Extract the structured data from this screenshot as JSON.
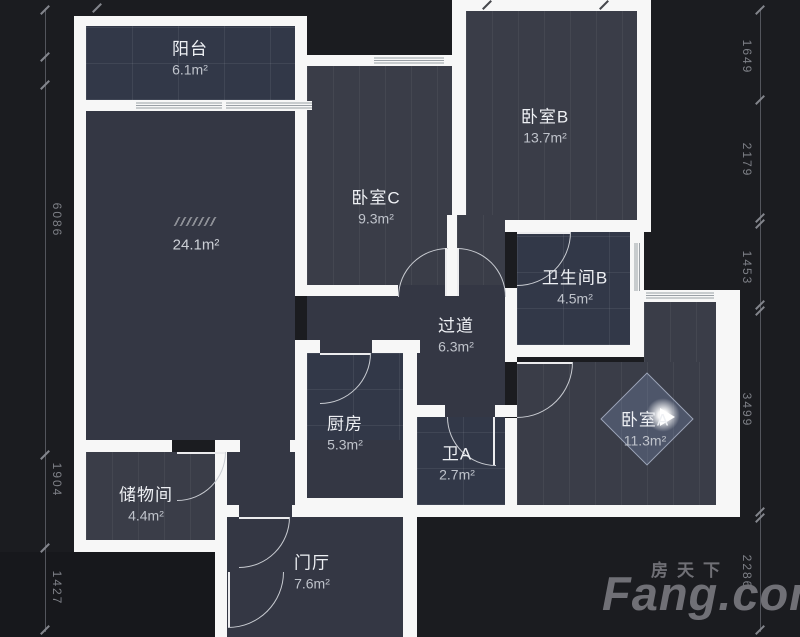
{
  "rooms": {
    "balcony": {
      "name": "阳台",
      "area": "6.1m²"
    },
    "living": {
      "name": "",
      "area": "24.1m²"
    },
    "bedroom_c": {
      "name": "卧室C",
      "area": "9.3m²"
    },
    "bedroom_b": {
      "name": "卧室B",
      "area": "13.7m²"
    },
    "bathroom_b": {
      "name": "卫生间B",
      "area": "4.5m²"
    },
    "corridor": {
      "name": "过道",
      "area": "6.3m²"
    },
    "kitchen": {
      "name": "厨房",
      "area": "5.3m²"
    },
    "bathroom_a": {
      "name": "卫A",
      "area": "2.7m²"
    },
    "bedroom_a": {
      "name": "卧室A",
      "area": "11.3m²"
    },
    "storage": {
      "name": "储物间",
      "area": "4.4m²"
    },
    "foyer": {
      "name": "门厅",
      "area": "7.6m²"
    }
  },
  "dimensions": {
    "left": [
      "6086",
      "1904",
      "1427"
    ],
    "right": [
      "1649",
      "2179",
      "1453",
      "3499",
      "2286"
    ]
  },
  "watermark": {
    "cn": "房天下",
    "en": "Fang.com"
  },
  "colors": {
    "background": "#1b1c20",
    "wall": "#f7f7f7",
    "floor": "#343744",
    "label_text": "#eef0f4",
    "dim_text": "#7e8087",
    "watermark_gray": "#707076"
  }
}
